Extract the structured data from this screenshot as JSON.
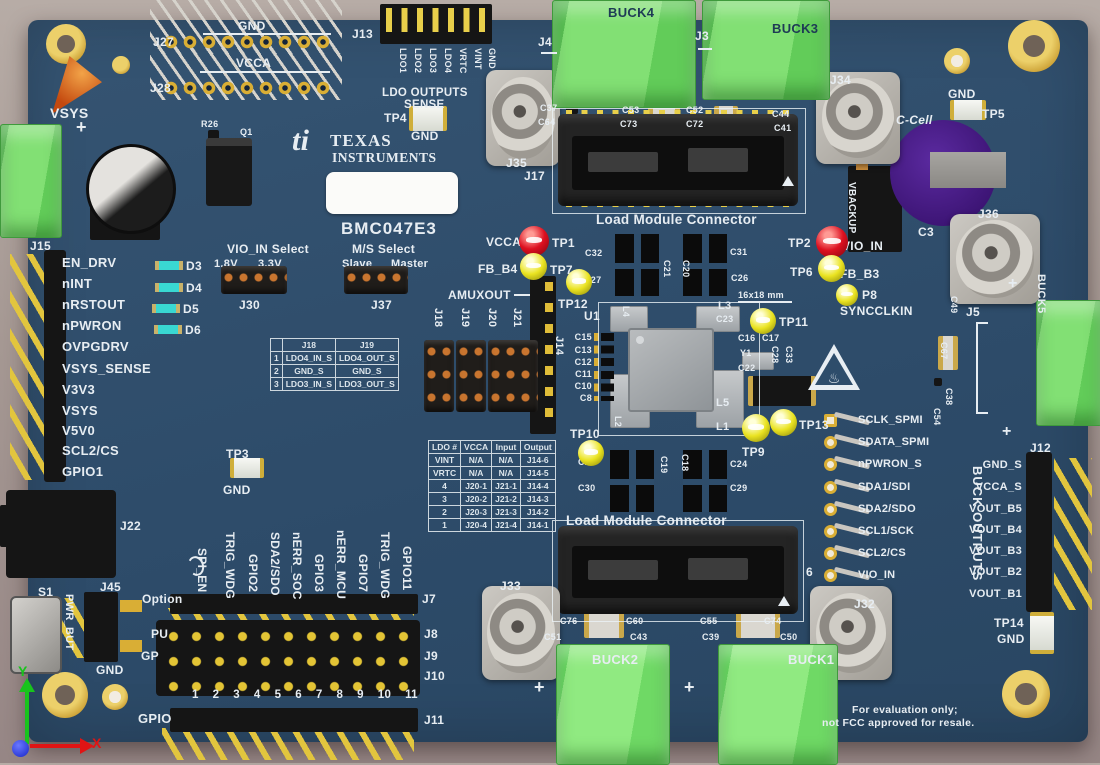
{
  "colors": {
    "board": "#2e4d6b",
    "silkscreen": "#e7edf2",
    "terminal_green": "#82e074",
    "terminal_green_light": "#90ea81",
    "gold": "#d9ae35",
    "test_point_red": "#dd1020",
    "test_point_yellow": "#eae321",
    "led_cyan": "#39d8d2",
    "battery_purple": "#471f86",
    "axis_x_red": "#e01414",
    "axis_y_green": "#18c41c"
  },
  "brand": {
    "logo": "ti",
    "line1": "TEXAS",
    "line2": "INSTRUMENTS",
    "board_id": "BMC047E3"
  },
  "silk": {
    "gnd_top": "GND",
    "j27": "J27",
    "vcca_top": "VCCA",
    "j28": "J28",
    "ldo_outputs": "LDO OUTPUTS",
    "sense": "SENSE",
    "tp4": "TP4",
    "tp4_gnd": "GND",
    "j4": "J4",
    "buck4": "BUCK4",
    "j3": "J3",
    "buck3": "BUCK3",
    "j35": "J35",
    "j34": "J34",
    "j17": "J17",
    "lmc_top": "Load Module Connector",
    "c37": "C37",
    "c64": "C64",
    "c53": "C53",
    "c73": "C73",
    "c52": "C52",
    "c72": "C72",
    "c44": "C44",
    "c41": "C41",
    "gnd_tp5": "GND",
    "tp5": "TP5",
    "c_cell": "C-Cell",
    "c3": "C3",
    "vbackup": "VBACKUP",
    "j36": "J36",
    "vsys": "VSYS",
    "plus": "+",
    "r26": "R26",
    "q1": "Q1",
    "vcca_tp1": "VCCA",
    "tp1": "TP1",
    "fb_b4": "FB_B4",
    "tp7": "TP7",
    "tp12": "TP12",
    "c32": "C32",
    "c27": "C27",
    "c21": "C21",
    "c20": "C20",
    "c31": "C31",
    "c26": "C26",
    "tp2": "TP2",
    "vio_in": "VIO_IN",
    "tp6": "TP6",
    "fb_b3": "FB_B3",
    "p8": "P8",
    "syncclkin": "SYNCCLKIN",
    "dim": "16x18 mm",
    "tp11": "TP11",
    "amuxout": "AMUXOUT",
    "j18": "J18",
    "j19": "J19",
    "j20": "J20",
    "j21": "J21",
    "j14": "J14",
    "u1": "U1",
    "l4": "L4",
    "l3": "L3",
    "c23": "C23",
    "c16": "C16",
    "c17": "C17",
    "y1": "Y1",
    "c22": "C22",
    "c28": "C28",
    "c33": "C33",
    "l5": "L5",
    "l2": "L2",
    "l1": "L1",
    "c15": "C15",
    "c13": "C13",
    "c12": "C12",
    "c11": "C11",
    "c10": "C10",
    "c8": "C8",
    "tp10": "TP10",
    "tp9": "TP9",
    "tp13": "TP13",
    "c25": "C25",
    "c30": "C30",
    "c19": "C19",
    "c18": "C18",
    "c24": "C24",
    "c29": "C29",
    "tp3": "TP3",
    "tp3_gnd": "GND",
    "j22": "J22",
    "s1": "S1",
    "pwr_but": "PWR_BUT",
    "j45": "J45",
    "j45_gnd": "GND",
    "lmc_bottom": "Load Module Connector",
    "j6": "6",
    "j33": "J33",
    "j32": "J32",
    "c76": "C76",
    "c60": "C60",
    "c51": "C51",
    "c43": "C43",
    "c55": "C55",
    "c74": "C74",
    "c39": "C39",
    "c50": "C50",
    "buck2": "BUCK2",
    "buck1": "BUCK1",
    "c49": "C49",
    "c67": "C67",
    "c38": "C38",
    "c54": "C54",
    "j5": "J5",
    "buck5": "BUCK5",
    "tp14": "TP14",
    "tp14_gnd": "GND",
    "hot_icon": "♨"
  },
  "j13": {
    "ref": "J13",
    "pins": [
      "LDO1",
      "LDO2",
      "LDO3",
      "LDO4",
      "VRTC",
      "VINT",
      "GND"
    ]
  },
  "j15": {
    "ref": "J15",
    "signals": [
      "EN_DRV",
      "nINT",
      "nRSTOUT",
      "nPWRON",
      "OVPGDRV",
      "VSYS_SENSE",
      "V3V3",
      "VSYS",
      "V5V0",
      "SCL2/CS",
      "GPIO1"
    ]
  },
  "leds": [
    "D3",
    "D4",
    "D5",
    "D6"
  ],
  "selects": {
    "vio_title": "VIO_IN Select",
    "vio_left": "1.8V",
    "vio_right": "3.3V",
    "vio_ref": "J30",
    "ms_title": "M/S Select",
    "ms_left": "Slave",
    "ms_right": "Master",
    "ms_ref": "J37"
  },
  "table_j18_j19": {
    "col0": "",
    "col1": "J18",
    "col2": "J19",
    "rows": [
      [
        "1",
        "LDO4_IN_S",
        "LDO4_OUT_S"
      ],
      [
        "2",
        "GND_S",
        "GND_S"
      ],
      [
        "3",
        "LDO3_IN_S",
        "LDO3_OUT_S"
      ]
    ]
  },
  "table_ldo": {
    "cols": [
      "LDO #",
      "VCCA",
      "Input",
      "Output"
    ],
    "rows": [
      [
        "VINT",
        "N/A",
        "N/A",
        "J14-6"
      ],
      [
        "VRTC",
        "N/A",
        "N/A",
        "J14-5"
      ],
      [
        "4",
        "J20-1",
        "J21-1",
        "J14-4"
      ],
      [
        "3",
        "J20-2",
        "J21-2",
        "J14-3"
      ],
      [
        "2",
        "J20-3",
        "J21-3",
        "J14-2"
      ],
      [
        "1",
        "J20-4",
        "J21-4",
        "J14-1"
      ]
    ]
  },
  "gpio_block": {
    "option": "Option",
    "pu": "PU",
    "gp": "GP",
    "gpio": "GPIO",
    "vertical": [
      "SPI_EN",
      "TRIG_WDG",
      "GPIO2",
      "SDA2/SDO",
      "nERR_SOC",
      "GPIO3",
      "nERR_MCU",
      "GPIO7",
      "TRIG_WDG",
      "GPIO11"
    ],
    "refs": [
      "J7",
      "J8",
      "J9",
      "J10",
      "J11"
    ],
    "pins": [
      "1",
      "2",
      "3",
      "4",
      "5",
      "6",
      "7",
      "8",
      "9",
      "10",
      "11"
    ]
  },
  "right_tp_labels": [
    "SCLK_SPMI",
    "SDATA_SPMI",
    "nPWRON_S",
    "SDA1/SDI",
    "SDA2/SDO",
    "SCL1/SCK",
    "SCL2/CS",
    "VIO_IN"
  ],
  "buck_outputs": {
    "ref": "J12",
    "title": "BUCK OUTPUTS",
    "pins": [
      "GND_S",
      "VCCA_S",
      "VOUT_B5",
      "VOUT_B4",
      "VOUT_B3",
      "VOUT_B2",
      "VOUT_B1"
    ]
  },
  "eval_note": {
    "line1": "For evaluation only;",
    "line2": "not FCC approved for resale."
  },
  "axes": {
    "x": "X",
    "y": "Y"
  }
}
